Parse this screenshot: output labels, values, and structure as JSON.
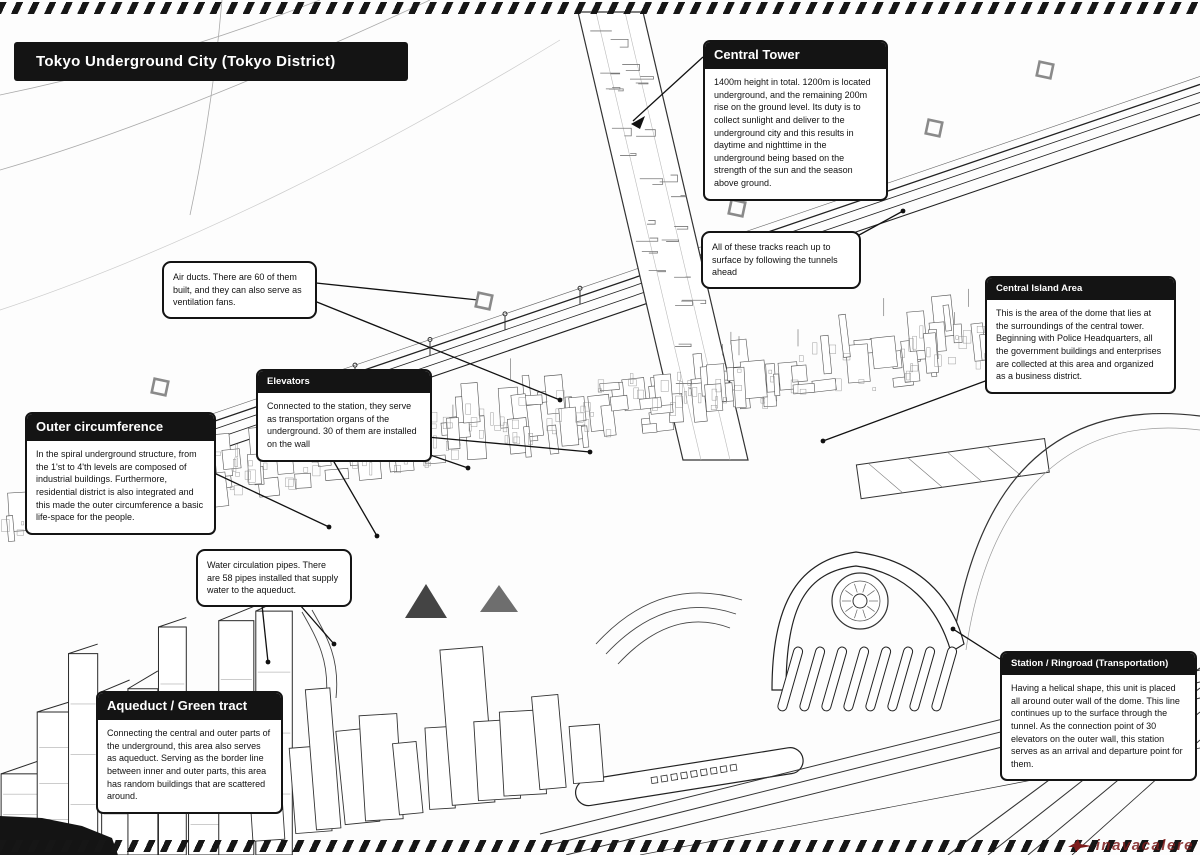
{
  "page": {
    "title": "Tokyo Underground City (Tokyo District)"
  },
  "callouts": {
    "central_tower": {
      "title": "Central Tower",
      "body": "1400m height in total. 1200m is located underground, and the remaining 200m rise on the ground level. Its duty is to collect sunlight and deliver to the underground city and this results in daytime and nighttime in the underground being based on the strength of the sun and the season above ground."
    },
    "tracks_note": {
      "body": "All of these tracks reach up to surface by following the tunnels ahead"
    },
    "central_island": {
      "title": "Central Island Area",
      "body": "This is the area of the dome that lies at the surroundings of the central tower. Beginning with Police Headquarters, all the government buildings and enterprises are collected at this area and organized as a business district."
    },
    "air_ducts": {
      "body": "Air ducts. There are 60 of them built, and they can also serve as ventilation fans."
    },
    "elevators": {
      "title": "Elevators",
      "body": "Connected to the station, they serve as transportation organs of the underground. 30 of them are installed on the wall"
    },
    "outer_circumference": {
      "title": "Outer circumference",
      "body": "In the spiral underground structure, from the 1'st to 4'th levels are composed of industrial buildings. Furthermore, residential district is also integrated and this made the outer circumference a basic life-space for the people."
    },
    "water_pipes": {
      "body": "Water circulation pipes. There are 58 pipes installed that supply water to the aqueduct."
    },
    "aqueduct": {
      "title": "Aqueduct / Green tract",
      "body": "Connecting the central and outer parts of the underground, this area also serves as aqueduct. Serving as the border line between inner and outer parts, this area has random buildings that are scattered around."
    },
    "station": {
      "title": "Station / Ringroad (Transportation)",
      "body": "Having a helical shape, this unit is placed all around outer wall of the dome. This line continues up to the surface through the tunnel. As the connection point of 30 elevators on the outer wall, this station serves as an arrival and departure point for them."
    }
  },
  "watermark": {
    "text": "inavacalere"
  },
  "colors": {
    "ink": "#141414",
    "watermark": "#7d1d1d"
  }
}
